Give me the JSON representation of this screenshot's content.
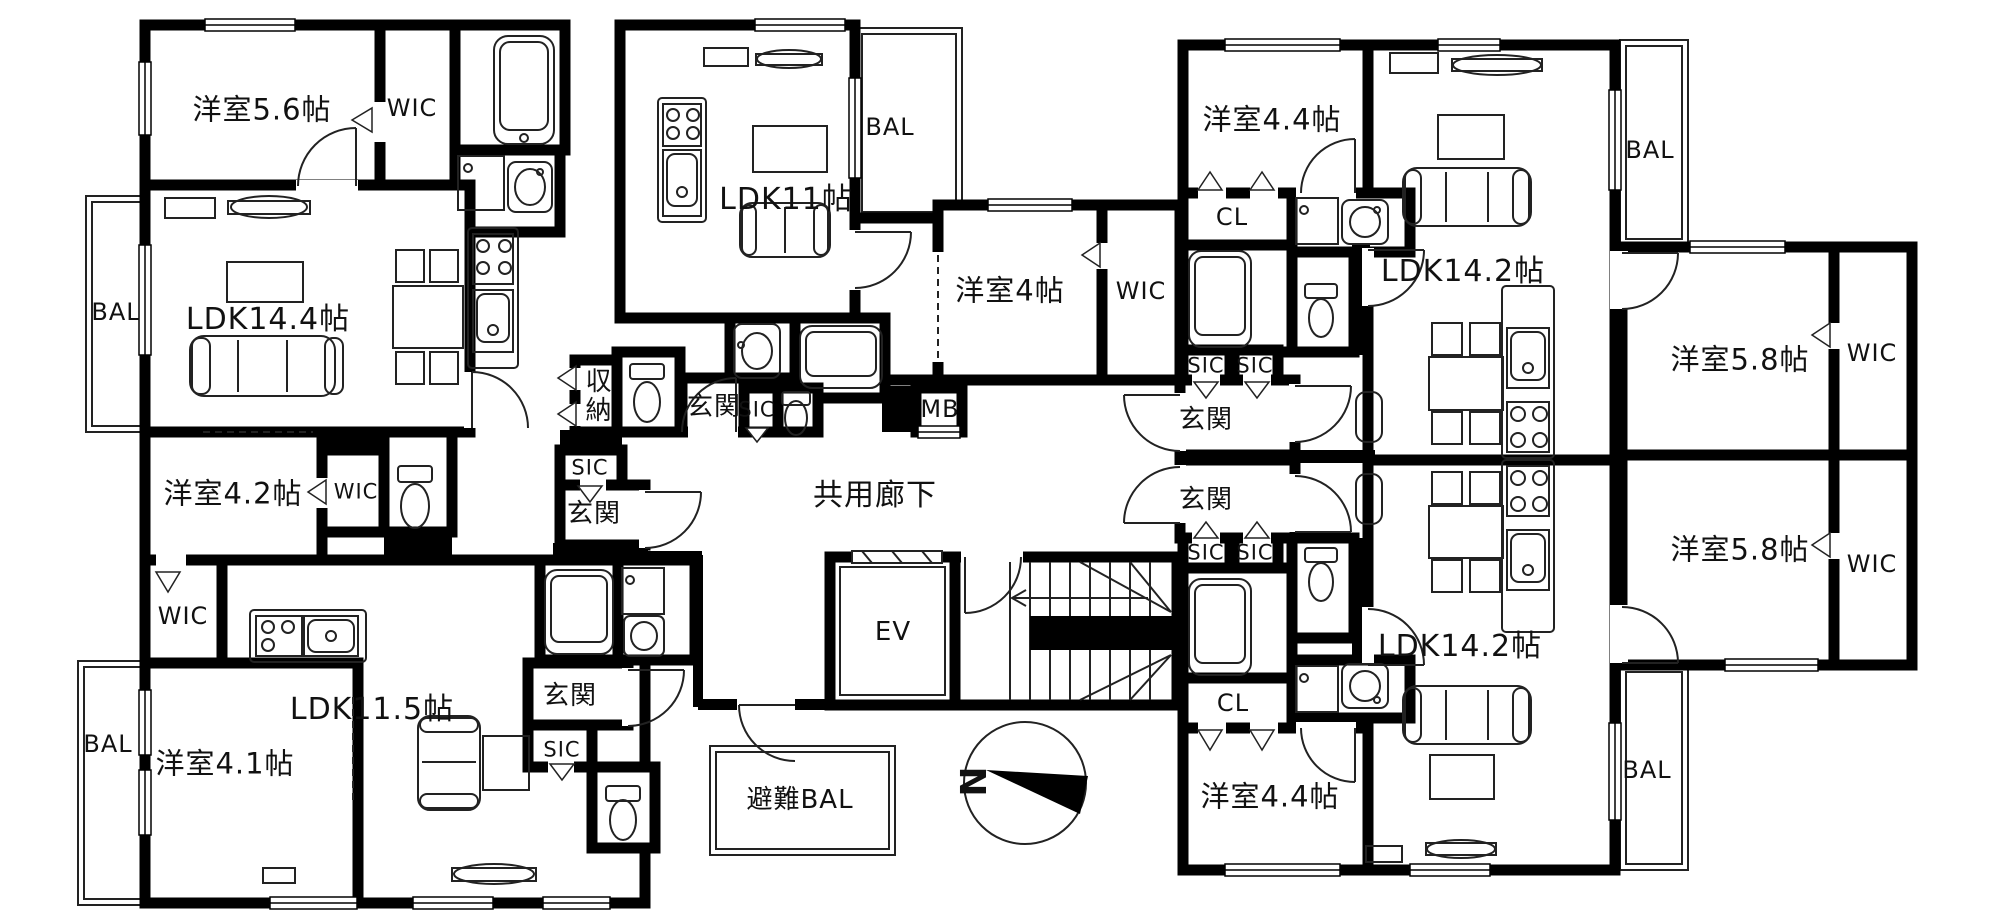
{
  "colors": {
    "wall": "#000000",
    "background": "#ffffff",
    "line": "#222222"
  },
  "compass": {
    "direction_label": "N"
  },
  "labels": [
    {
      "id": "western-room-5-6",
      "text": "洋室5.6帖"
    },
    {
      "id": "wic-a1",
      "text": "WIC"
    },
    {
      "id": "bal-a",
      "text": "BAL"
    },
    {
      "id": "ldk-14-4",
      "text": "LDK14.4帖"
    },
    {
      "id": "western-room-4-2",
      "text": "洋室4.2帖"
    },
    {
      "id": "wic-a2",
      "text": "WIC"
    },
    {
      "id": "storage",
      "text": "収納"
    },
    {
      "id": "sic-a",
      "text": "SIC"
    },
    {
      "id": "genkan-a",
      "text": "玄関"
    },
    {
      "id": "ldk-11",
      "text": "LDK11帖"
    },
    {
      "id": "bal-b",
      "text": "BAL"
    },
    {
      "id": "western-room-4",
      "text": "洋室4帖"
    },
    {
      "id": "wic-b",
      "text": "WIC"
    },
    {
      "id": "genkan-b",
      "text": "玄関"
    },
    {
      "id": "sic-b",
      "text": "SIC"
    },
    {
      "id": "mb",
      "text": "MB"
    },
    {
      "id": "common-corridor",
      "text": "共用廊下"
    },
    {
      "id": "elevator",
      "text": "EV"
    },
    {
      "id": "wic-c",
      "text": "WIC"
    },
    {
      "id": "bal-c",
      "text": "BAL"
    },
    {
      "id": "western-room-4-1",
      "text": "洋室4.1帖"
    },
    {
      "id": "ldk-11-5",
      "text": "LDK11.5帖"
    },
    {
      "id": "genkan-c",
      "text": "玄関"
    },
    {
      "id": "sic-c",
      "text": "SIC"
    },
    {
      "id": "evacuation-balcony",
      "text": "避難BAL"
    },
    {
      "id": "western-room-4-4-north",
      "text": "洋室4.4帖"
    },
    {
      "id": "cl-north",
      "text": "CL"
    },
    {
      "id": "ldk-14-2-north",
      "text": "LDK14.2帖"
    },
    {
      "id": "bal-d",
      "text": "BAL"
    },
    {
      "id": "sic-d1",
      "text": "SIC"
    },
    {
      "id": "sic-d2",
      "text": "SIC"
    },
    {
      "id": "genkan-d",
      "text": "玄関"
    },
    {
      "id": "western-room-5-8-north",
      "text": "洋室5.8帖"
    },
    {
      "id": "wic-f1",
      "text": "WIC"
    },
    {
      "id": "genkan-e",
      "text": "玄関"
    },
    {
      "id": "sic-e1",
      "text": "SIC"
    },
    {
      "id": "sic-e2",
      "text": "SIC"
    },
    {
      "id": "cl-south",
      "text": "CL"
    },
    {
      "id": "western-room-4-4-south",
      "text": "洋室4.4帖"
    },
    {
      "id": "ldk-14-2-south",
      "text": "LDK14.2帖"
    },
    {
      "id": "bal-e",
      "text": "BAL"
    },
    {
      "id": "western-room-5-8-south",
      "text": "洋室5.8帖"
    },
    {
      "id": "wic-f2",
      "text": "WIC"
    },
    {
      "id": "compass-n",
      "text": "N"
    }
  ]
}
